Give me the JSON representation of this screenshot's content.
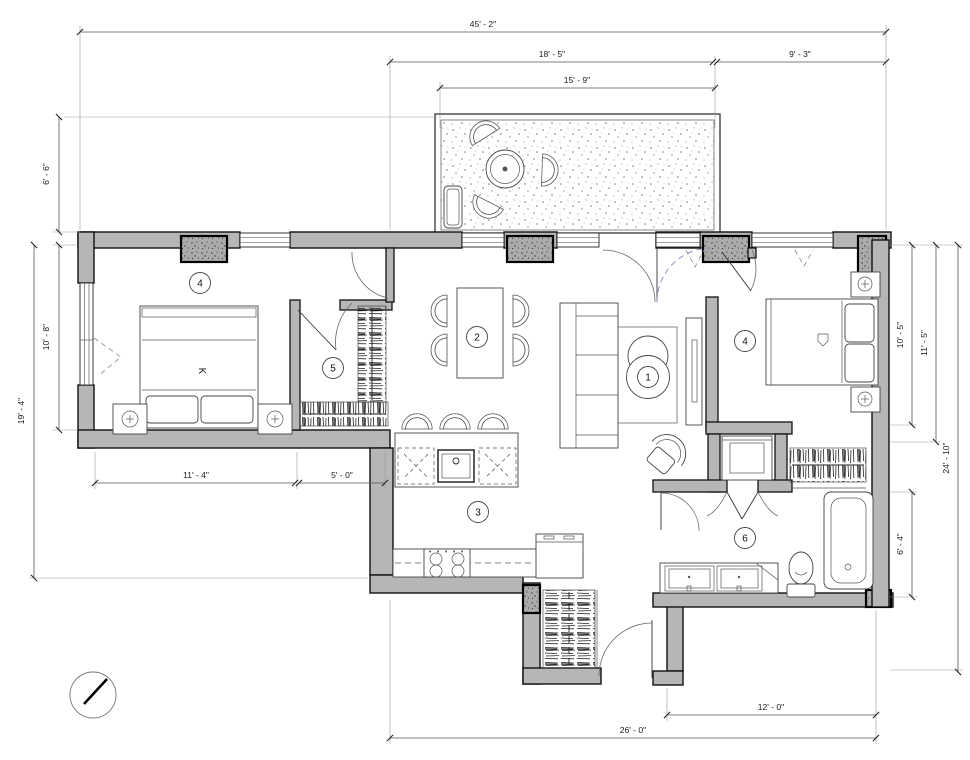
{
  "drawing": {
    "type": "apartment-floor-plan",
    "wall_color": "#b6b6b6",
    "line_color": "#111111",
    "door_dash_color": "#8585b5"
  },
  "dimensions": {
    "overall_width": "45' - 2\"",
    "patio_span": "18' - 5\"",
    "right_span": "9' - 3\"",
    "patio_width": "15' - 9\"",
    "patio_depth": "6' - 6\"",
    "bedroom_window": "10' - 8\"",
    "left_height": "19' - 4\"",
    "bedroom_right_width": "10' - 5\"",
    "bedroom_right_depth": "11' - 5\"",
    "right_height": "24' - 10\"",
    "bath_depth": "6' - 4\"",
    "bedroom_left_width": "11' - 4\"",
    "closet_width": "5' - 0\"",
    "bath_width": "12' - 0\"",
    "bottom_width": "26' - 0\""
  },
  "rooms": {
    "living": "1",
    "dining": "2",
    "kitchen": "3",
    "bedroom_left": "4",
    "bedroom_right": "4",
    "closet": "5",
    "bathroom": "6"
  },
  "bed": {
    "size_label": "K"
  }
}
